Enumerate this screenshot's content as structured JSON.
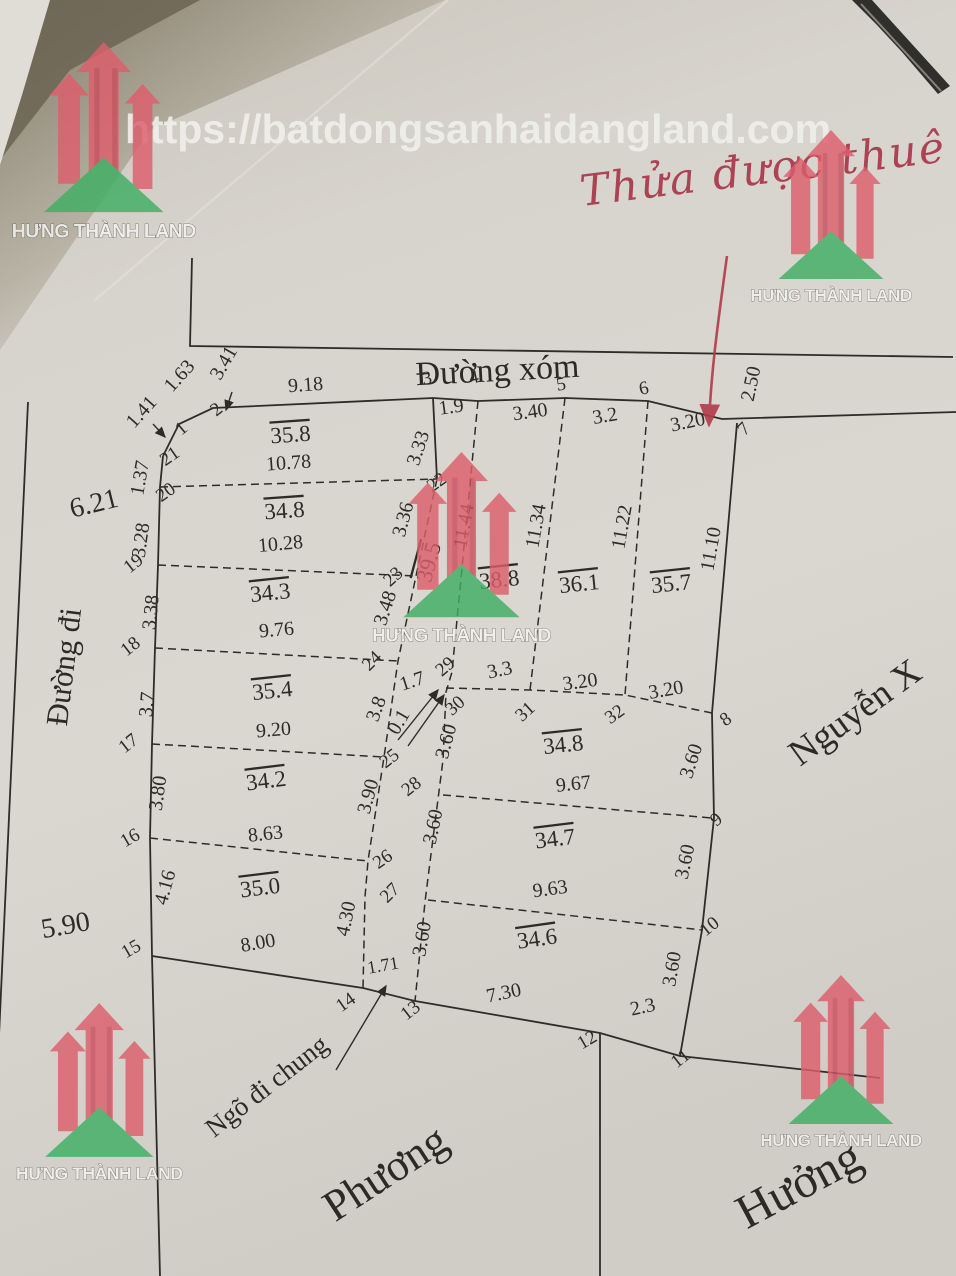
{
  "watermarks": {
    "url": "https://batdongsanhaidangland.com",
    "brand": "HƯNG THÀNH LAND"
  },
  "handwriting": {
    "note": "Thửa được thuê của"
  },
  "labels": {
    "top_road": "Đường xóm",
    "left_road": "Đường đi",
    "right_road": "Nguyễn X",
    "alley": "Ngõ đi chung",
    "neighbor_bottom": "Phương",
    "neighbor_right": "Hưởng",
    "left_outer_width_top": "6.21",
    "left_outer_width_bottom": "5.90"
  },
  "parcels": [
    {
      "t": "35.8",
      "x": 291,
      "y": 442,
      "r": -4
    },
    {
      "t": "34.8",
      "x": 285,
      "y": 518,
      "r": -4
    },
    {
      "t": "34.3",
      "x": 271,
      "y": 600,
      "r": -6
    },
    {
      "t": "35.4",
      "x": 273,
      "y": 698,
      "r": -6
    },
    {
      "t": "34.2",
      "x": 267,
      "y": 788,
      "r": -7
    },
    {
      "t": "35.0",
      "x": 261,
      "y": 895,
      "r": -7
    },
    {
      "t": "38.8",
      "x": 500,
      "y": 587,
      "r": -6
    },
    {
      "t": "36.1",
      "x": 580,
      "y": 591,
      "r": -6
    },
    {
      "t": "35.7",
      "x": 672,
      "y": 591,
      "r": -6
    },
    {
      "t": "34.8",
      "x": 564,
      "y": 752,
      "r": -6
    },
    {
      "t": "34.7",
      "x": 556,
      "y": 846,
      "r": -7
    },
    {
      "t": "34.6",
      "x": 538,
      "y": 946,
      "r": -8
    },
    {
      "t": "39.5",
      "x": 436,
      "y": 564,
      "r": -75
    }
  ],
  "measurements": [
    {
      "t": "1.41",
      "x": 146,
      "y": 416,
      "r": -48
    },
    {
      "t": "1.63",
      "x": 184,
      "y": 380,
      "r": -48
    },
    {
      "t": "3.41",
      "x": 229,
      "y": 366,
      "r": -60
    },
    {
      "t": "9.18",
      "x": 306,
      "y": 391,
      "r": -4
    },
    {
      "t": "1.9",
      "x": 452,
      "y": 413,
      "r": -8
    },
    {
      "t": "3.40",
      "x": 531,
      "y": 418,
      "r": -8
    },
    {
      "t": "3.2",
      "x": 606,
      "y": 422,
      "r": -10
    },
    {
      "t": "3.20",
      "x": 689,
      "y": 428,
      "r": -12
    },
    {
      "t": "2.50",
      "x": 757,
      "y": 385,
      "r": -78
    },
    {
      "t": "1.37",
      "x": 146,
      "y": 479,
      "r": -80
    },
    {
      "t": "3.28",
      "x": 147,
      "y": 541,
      "r": -82
    },
    {
      "t": "3.38",
      "x": 157,
      "y": 613,
      "r": -84
    },
    {
      "t": "3.7",
      "x": 153,
      "y": 705,
      "r": -85
    },
    {
      "t": "3.80",
      "x": 164,
      "y": 794,
      "r": -82
    },
    {
      "t": "4.16",
      "x": 171,
      "y": 889,
      "r": -75
    },
    {
      "t": "3.33",
      "x": 424,
      "y": 450,
      "r": -72
    },
    {
      "t": "3.36",
      "x": 409,
      "y": 521,
      "r": -75
    },
    {
      "t": "3.48",
      "x": 391,
      "y": 610,
      "r": -72
    },
    {
      "t": "3.8",
      "x": 382,
      "y": 711,
      "r": -70
    },
    {
      "t": "3.90",
      "x": 374,
      "y": 798,
      "r": -75
    },
    {
      "t": "4.30",
      "x": 352,
      "y": 920,
      "r": -78
    },
    {
      "t": "11.44",
      "x": 470,
      "y": 527,
      "r": -80
    },
    {
      "t": "11.34",
      "x": 542,
      "y": 527,
      "r": -80
    },
    {
      "t": "11.22",
      "x": 628,
      "y": 528,
      "r": -80
    },
    {
      "t": "11.10",
      "x": 717,
      "y": 550,
      "r": -80
    },
    {
      "t": "1.7",
      "x": 414,
      "y": 687,
      "r": -18
    },
    {
      "t": "0.1",
      "x": 404,
      "y": 725,
      "r": -60
    },
    {
      "t": "3.3",
      "x": 501,
      "y": 676,
      "r": -12
    },
    {
      "t": "3.20",
      "x": 581,
      "y": 688,
      "r": -8
    },
    {
      "t": "3.20",
      "x": 667,
      "y": 696,
      "r": -10
    },
    {
      "t": "3.60",
      "x": 452,
      "y": 743,
      "r": -75
    },
    {
      "t": "3.60",
      "x": 439,
      "y": 828,
      "r": -78
    },
    {
      "t": "3.60",
      "x": 428,
      "y": 940,
      "r": -80
    },
    {
      "t": "3.60",
      "x": 697,
      "y": 763,
      "r": -72
    },
    {
      "t": "3.60",
      "x": 691,
      "y": 863,
      "r": -78
    },
    {
      "t": "3.60",
      "x": 678,
      "y": 970,
      "r": -80
    },
    {
      "t": "9.67",
      "x": 574,
      "y": 790,
      "r": -6
    },
    {
      "t": "9.63",
      "x": 551,
      "y": 895,
      "r": -8
    },
    {
      "t": "7.30",
      "x": 505,
      "y": 999,
      "r": -12
    },
    {
      "t": "2.3",
      "x": 644,
      "y": 1013,
      "r": -12
    },
    {
      "t": "1.71",
      "x": 384,
      "y": 971,
      "r": -10,
      "s": 18
    },
    {
      "t": "10.78",
      "x": 289,
      "y": 469,
      "r": -4
    },
    {
      "t": "10.28",
      "x": 281,
      "y": 550,
      "r": -5
    },
    {
      "t": "9.76",
      "x": 277,
      "y": 636,
      "r": -5
    },
    {
      "t": "9.20",
      "x": 274,
      "y": 736,
      "r": -5
    },
    {
      "t": "8.63",
      "x": 266,
      "y": 840,
      "r": -6
    },
    {
      "t": "8.00",
      "x": 259,
      "y": 949,
      "r": -10
    }
  ],
  "vertices": [
    {
      "t": "1",
      "x": 185,
      "y": 433,
      "r": -40
    },
    {
      "t": "2",
      "x": 220,
      "y": 414,
      "r": -38
    },
    {
      "t": "3",
      "x": 428,
      "y": 384,
      "r": -10
    },
    {
      "t": "4",
      "x": 475,
      "y": 383,
      "r": -12
    },
    {
      "t": "5",
      "x": 562,
      "y": 390,
      "r": -10
    },
    {
      "t": "6",
      "x": 645,
      "y": 394,
      "r": -12
    },
    {
      "t": "7",
      "x": 748,
      "y": 433,
      "r": -45
    },
    {
      "t": "8",
      "x": 729,
      "y": 724,
      "r": -35
    },
    {
      "t": "9",
      "x": 720,
      "y": 824,
      "r": -40
    },
    {
      "t": "10",
      "x": 713,
      "y": 931,
      "r": -38
    },
    {
      "t": "11",
      "x": 684,
      "y": 1063,
      "r": -38
    },
    {
      "t": "12",
      "x": 590,
      "y": 1045,
      "r": -30
    },
    {
      "t": "13",
      "x": 414,
      "y": 1015,
      "r": -38
    },
    {
      "t": "14",
      "x": 349,
      "y": 1007,
      "r": -35
    },
    {
      "t": "15",
      "x": 134,
      "y": 954,
      "r": -30
    },
    {
      "t": "16",
      "x": 133,
      "y": 843,
      "r": -30
    },
    {
      "t": "17",
      "x": 132,
      "y": 748,
      "r": -38
    },
    {
      "t": "18",
      "x": 134,
      "y": 651,
      "r": -38
    },
    {
      "t": "19",
      "x": 137,
      "y": 568,
      "r": -38
    },
    {
      "t": "20",
      "x": 169,
      "y": 497,
      "r": -35
    },
    {
      "t": "21",
      "x": 173,
      "y": 461,
      "r": -35
    },
    {
      "t": "22",
      "x": 440,
      "y": 487,
      "r": -35
    },
    {
      "t": "23",
      "x": 397,
      "y": 581,
      "r": -42
    },
    {
      "t": "24",
      "x": 376,
      "y": 665,
      "r": -45
    },
    {
      "t": "25",
      "x": 393,
      "y": 763,
      "r": -38
    },
    {
      "t": "26",
      "x": 386,
      "y": 864,
      "r": -35
    },
    {
      "t": "27",
      "x": 394,
      "y": 897,
      "r": -45
    },
    {
      "t": "28",
      "x": 415,
      "y": 791,
      "r": -38
    },
    {
      "t": "29",
      "x": 449,
      "y": 671,
      "r": -40
    },
    {
      "t": "30",
      "x": 459,
      "y": 710,
      "r": -42
    },
    {
      "t": "31",
      "x": 529,
      "y": 716,
      "r": -42
    },
    {
      "t": "32",
      "x": 618,
      "y": 719,
      "r": -35
    }
  ]
}
